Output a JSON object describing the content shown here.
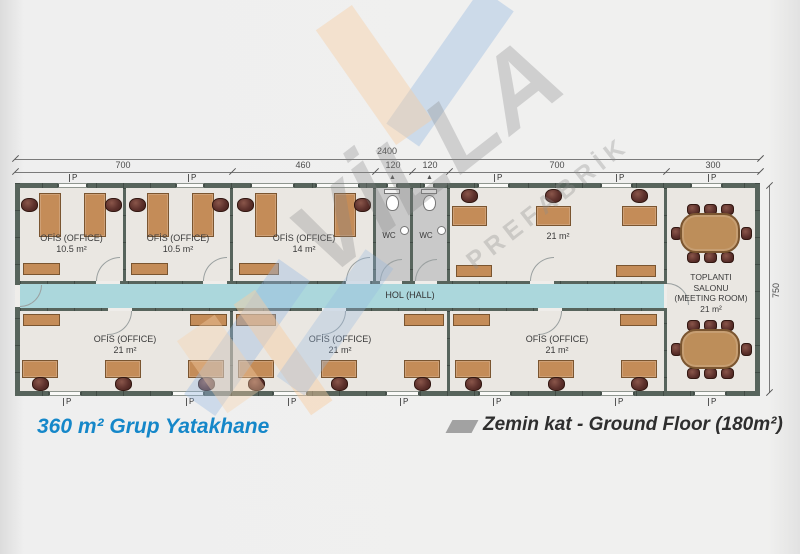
{
  "titles": {
    "left": "360 m² Grup Yatakhane",
    "right": "Zemin kat - Ground Floor (180m²)"
  },
  "dims": {
    "total": "2400",
    "segments": [
      "700",
      "460",
      "120",
      "120",
      "700",
      "300"
    ],
    "height": "750"
  },
  "labels": {
    "window": "P",
    "hall": "HOL (HALL)",
    "wc": "WC",
    "vent": "▲"
  },
  "rooms": {
    "office_a": {
      "name": "OFİS (OFFICE)",
      "area": "10.5 m²"
    },
    "office_b": {
      "name": "OFİS (OFFICE)",
      "area": "10.5 m²"
    },
    "office_c": {
      "name": "OFİS (OFFICE)",
      "area": "14 m²"
    },
    "office_d": {
      "area": "21 m²"
    },
    "office_e": {
      "name": "OFİS (OFFICE)",
      "area": "21 m²"
    },
    "office_f": {
      "name": "OFİS (OFFICE)",
      "area": "21 m²"
    },
    "office_g": {
      "name": "OFİS (OFFICE)",
      "area": "21 m²"
    },
    "meeting": {
      "line1": "TOPLANTI",
      "line2": "SALONU",
      "line3": "(MEETING ROOM)",
      "area": "21 m²"
    }
  },
  "watermark": {
    "brand": "VİLLA",
    "sub": "PREFABRİK"
  },
  "colors": {
    "accent_blue": "#1587c9",
    "wall": "#57645c",
    "hall_floor": "#abd7dc",
    "room_floor": "#eae7e2",
    "wc_floor": "#c9c9c9",
    "desk": "#c48c58",
    "chair": "#5d312c",
    "dim_text": "#4c4c4c"
  }
}
